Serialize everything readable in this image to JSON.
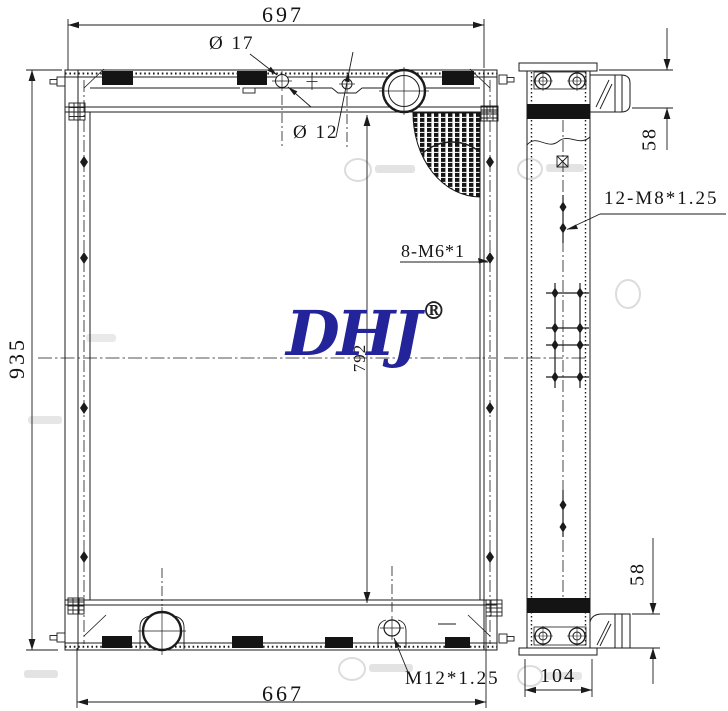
{
  "logo": {
    "text": "DHJ",
    "registered": "®",
    "color": "#23239a"
  },
  "dimensions": {
    "overall_width": "697",
    "overall_height": "935",
    "bottom_width": "667",
    "core_height": "792",
    "tank_height_top": "58",
    "tank_height_bottom": "58",
    "side_depth": "104"
  },
  "callouts": {
    "filler_hole_dia": "Ø 17",
    "small_hole_dia": "Ø 12",
    "side_frame_threads": "8-M6*1",
    "side_member_threads": "12-M8*1.25",
    "drain_thread": "M12*1.25"
  },
  "colors": {
    "line": "#1b1b1b",
    "logo_blue": "#23239a",
    "watermark": "#dcdcdc"
  }
}
